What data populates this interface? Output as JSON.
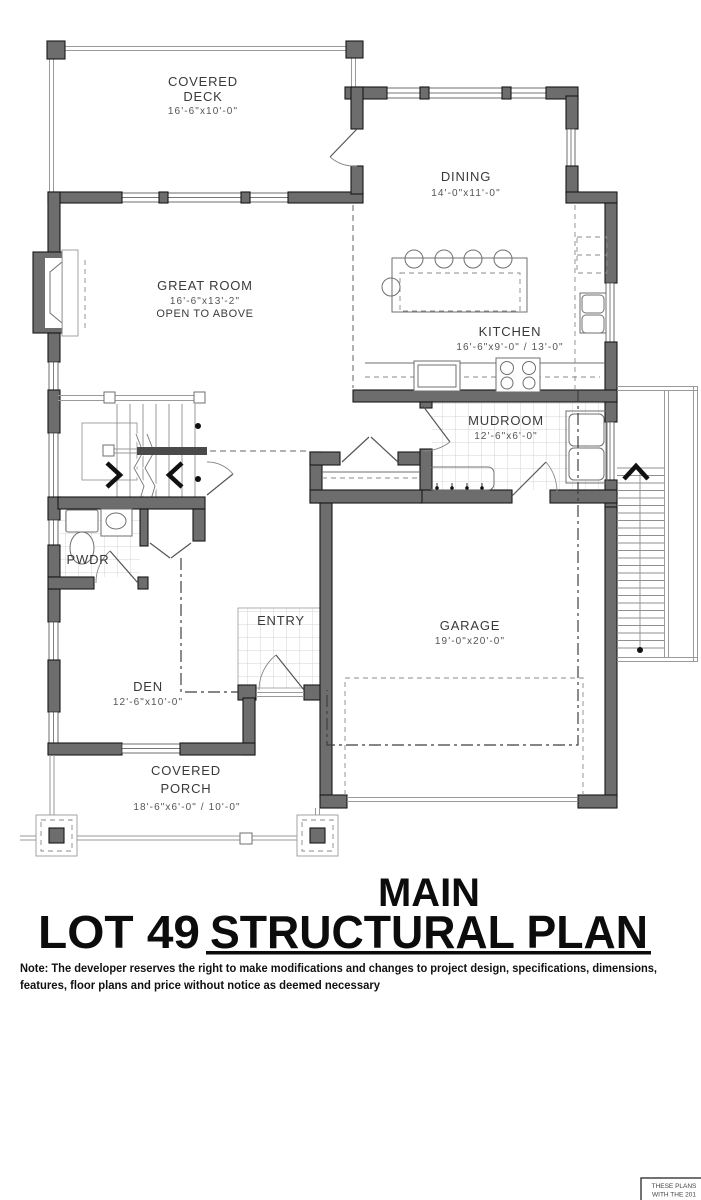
{
  "rooms": {
    "covered_deck": {
      "name_line1": "COVERED",
      "name_line2": "DECK",
      "dims": "16'-6\"x10'-0\""
    },
    "dining": {
      "name": "DINING",
      "dims": "14'-0\"x11'-0\""
    },
    "great_room": {
      "name": "GREAT ROOM",
      "dims": "16'-6\"x13'-2\"",
      "note": "OPEN TO ABOVE"
    },
    "kitchen": {
      "name": "KITCHEN",
      "dims": "16'-6\"x9'-0\" / 13'-0\""
    },
    "mudroom": {
      "name": "MUDROOM",
      "dims": "12'-6\"x6'-0\""
    },
    "pwdr": {
      "name": "PWDR"
    },
    "entry": {
      "name": "ENTRY"
    },
    "garage": {
      "name": "GARAGE",
      "dims": "19'-0\"x20'-0\""
    },
    "den": {
      "name": "DEN",
      "dims": "12'-6\"x10'-0\""
    },
    "covered_porch": {
      "name_line1": "COVERED",
      "name_line2": "PORCH",
      "dims": "18'-6\"x6'-0\" / 10'-0\""
    }
  },
  "title_block": {
    "level": "MAIN",
    "lot": "LOT 49",
    "plan_type": "STRUCTURAL PLAN"
  },
  "disclaimer": {
    "line1": "Note: The developer reserves the right to make modifications and changes to project design, specifications, dimensions,",
    "line2": "features, floor plans and price without notice as deemed necessary"
  },
  "stamp": {
    "line1": "THESE PLANS",
    "line2": "WITH THE 201"
  },
  "colors": {
    "wall_fill": "#6d6d6d",
    "wall_stroke": "#171717",
    "thin_line": "#8f8f8f",
    "text": "#3a3a3a",
    "dims_text": "#555555",
    "title_text": "#0c0c0c",
    "background": "#ffffff"
  }
}
